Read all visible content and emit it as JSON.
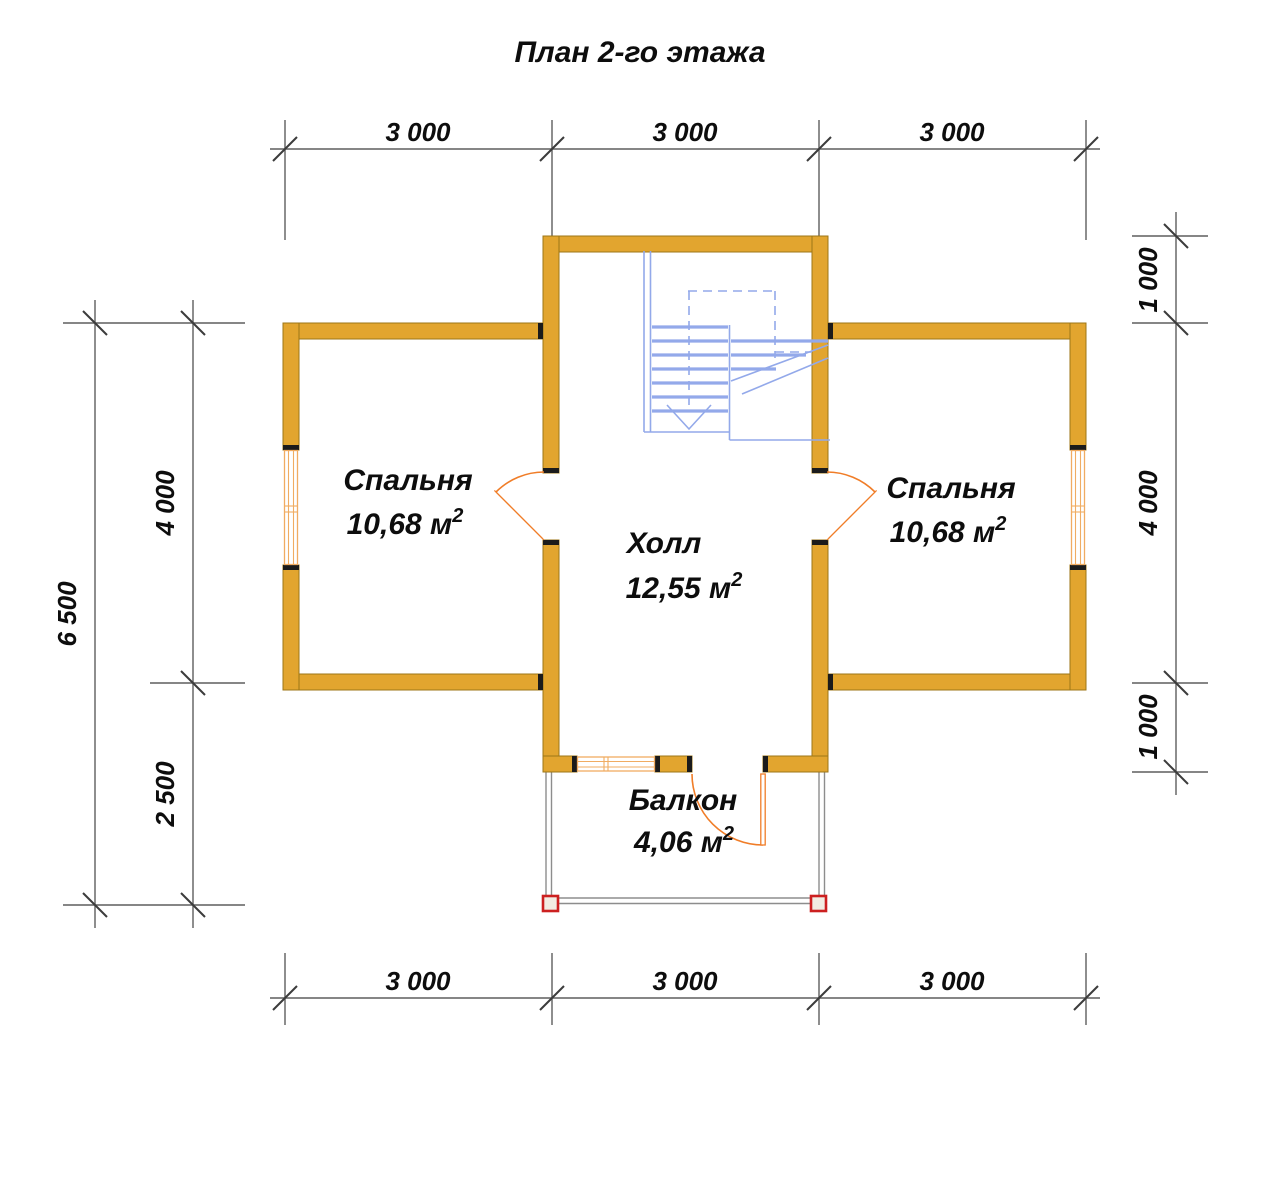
{
  "title": "План 2-го этажа",
  "rooms": [
    {
      "name": "Спальня",
      "area": "10,68 м",
      "area_sup": "2"
    },
    {
      "name": "Холл",
      "area": "12,55 м",
      "area_sup": "2"
    },
    {
      "name": "Спальня",
      "area": "10,68 м",
      "area_sup": "2"
    },
    {
      "name": "Балкон",
      "area": "4,06 м",
      "area_sup": "2"
    }
  ],
  "dimensions": {
    "top": [
      "3 000",
      "3 000",
      "3 000"
    ],
    "bottom": [
      "3 000",
      "3 000",
      "3 000"
    ],
    "left_outer": "6 500",
    "left_inner": [
      "4 000",
      "2 500"
    ],
    "right": [
      "1 000",
      "4 000",
      "1 000"
    ]
  },
  "colors": {
    "wall": "#E2A52F",
    "wall-border": "#9C7617",
    "cap": "#1B1B1B",
    "opening": "#F07D28",
    "window-frame": "#F0AC62",
    "stair": "#93A9EA",
    "railing": "#8D8D8D",
    "post": "#CC2020",
    "dim-line": "#5E5E5E",
    "text": "#0D0D0D"
  }
}
